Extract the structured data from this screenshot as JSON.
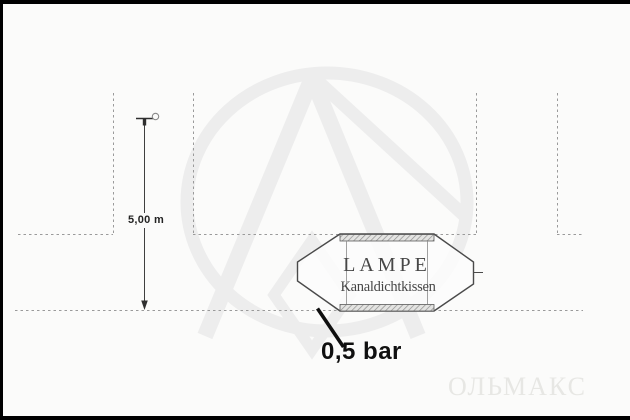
{
  "diagram": {
    "product": {
      "title": "LAMPE",
      "subtitle": "Kanaldichtkissen"
    },
    "dimensions": {
      "depth_label": "5,00 m",
      "pressure_label": "0,5 bar"
    },
    "watermark_text": "ОЛЬМАКС",
    "colors": {
      "background": "#fbfbfa",
      "frame": "#000000",
      "dashed_line": "#9a9a9a",
      "outline_dark": "#4a4a4a",
      "label_black": "#101010",
      "hatch_stroke": "#8f8f8f",
      "watermark_gray": "#ededed",
      "watermark_text_gray": "#e7e7e4"
    }
  }
}
